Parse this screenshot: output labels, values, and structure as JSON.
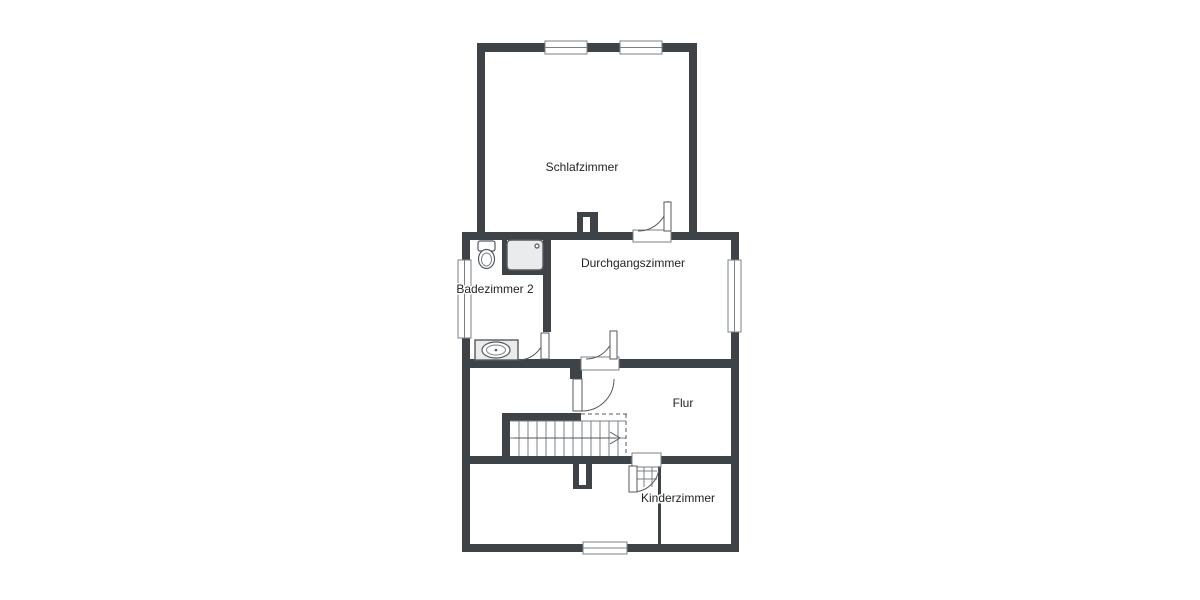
{
  "colors": {
    "page": "#ffffff",
    "wall": "#3e4347",
    "line": "#555a5e",
    "line_light": "#7a8084",
    "fixture_fill": "#e9ebed",
    "text": "#1f2123",
    "white": "#ffffff"
  },
  "rooms": {
    "schlafzimmer": {
      "label": "Schlafzimmer"
    },
    "durchgangszimmer": {
      "label": "Durchgangszimmer"
    },
    "badezimmer": {
      "label": "Badezimmer 2"
    },
    "flur": {
      "label": "Flur"
    },
    "kinderzimmer": {
      "label": "Kinderzimmer"
    }
  }
}
